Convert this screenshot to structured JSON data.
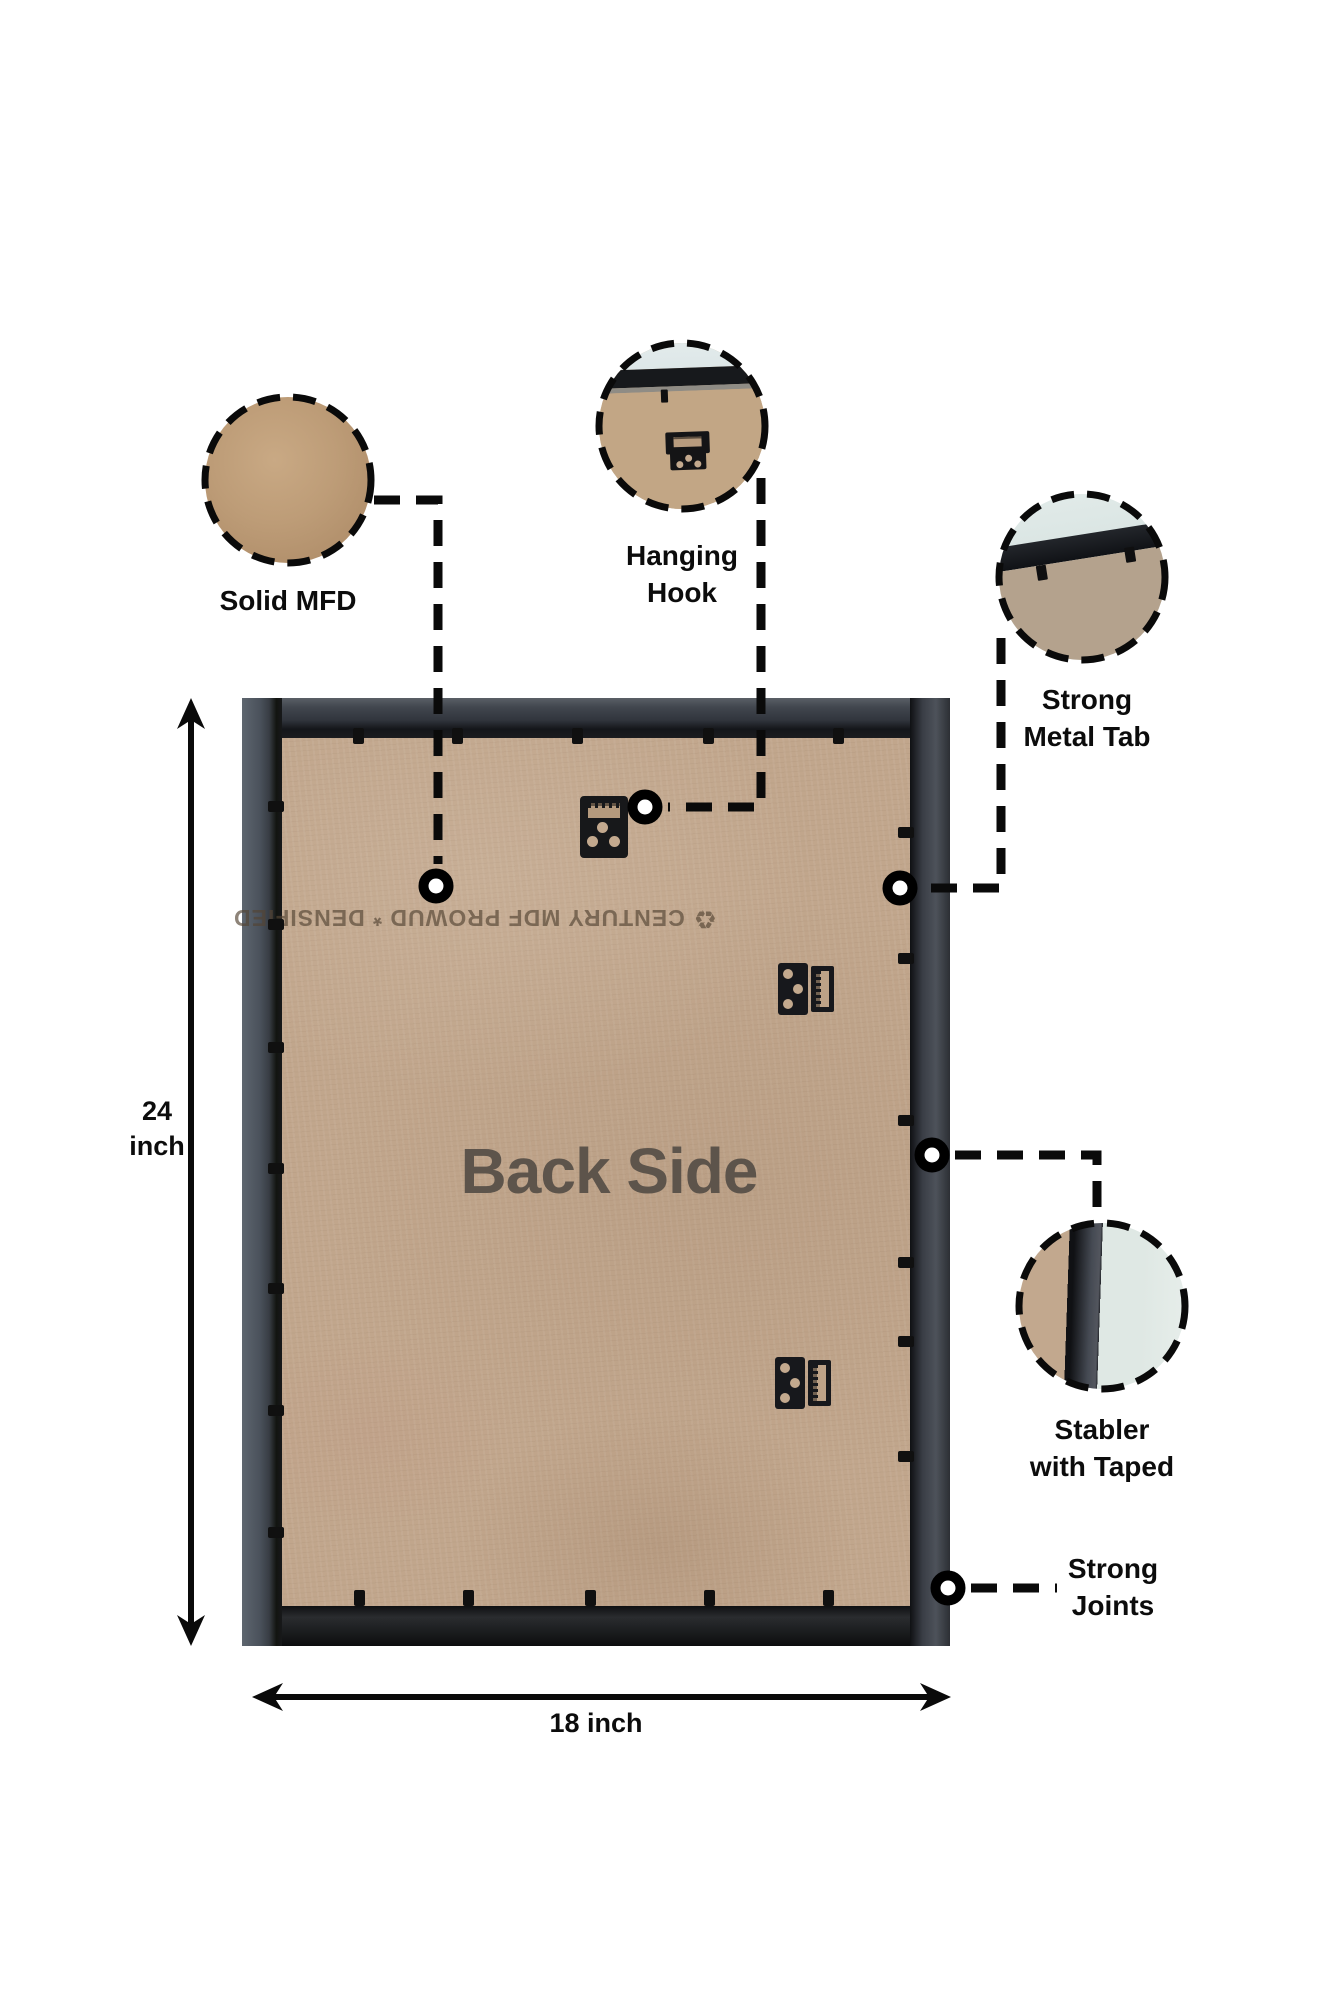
{
  "image": {
    "type": "product-back-side-infographic",
    "center_label": "Back Side",
    "watermark": {
      "recycle_symbol": "♻",
      "text": "CENTURY MDF PROWUD * DENSIFIED"
    },
    "callouts": {
      "solid_mfd": "Solid MFD",
      "hanging_hook": "Hanging\nHook",
      "strong_metal_tab": "Strong\nMetal Tab",
      "stabler": "Stabler\nwith Taped",
      "strong_joints": "Strong\nJoints"
    },
    "dimensions": {
      "height": "24\ninch",
      "width": "18 inch"
    },
    "colors": {
      "background": "#ffffff",
      "mdf_panel": "#c1a68c",
      "mdf_circle": "#bd9c77",
      "frame_dark": "#2e3034",
      "wall_mint": "#e9efec",
      "annotation_black": "#0b0b0b",
      "back_side_text": "#5d544b"
    }
  }
}
